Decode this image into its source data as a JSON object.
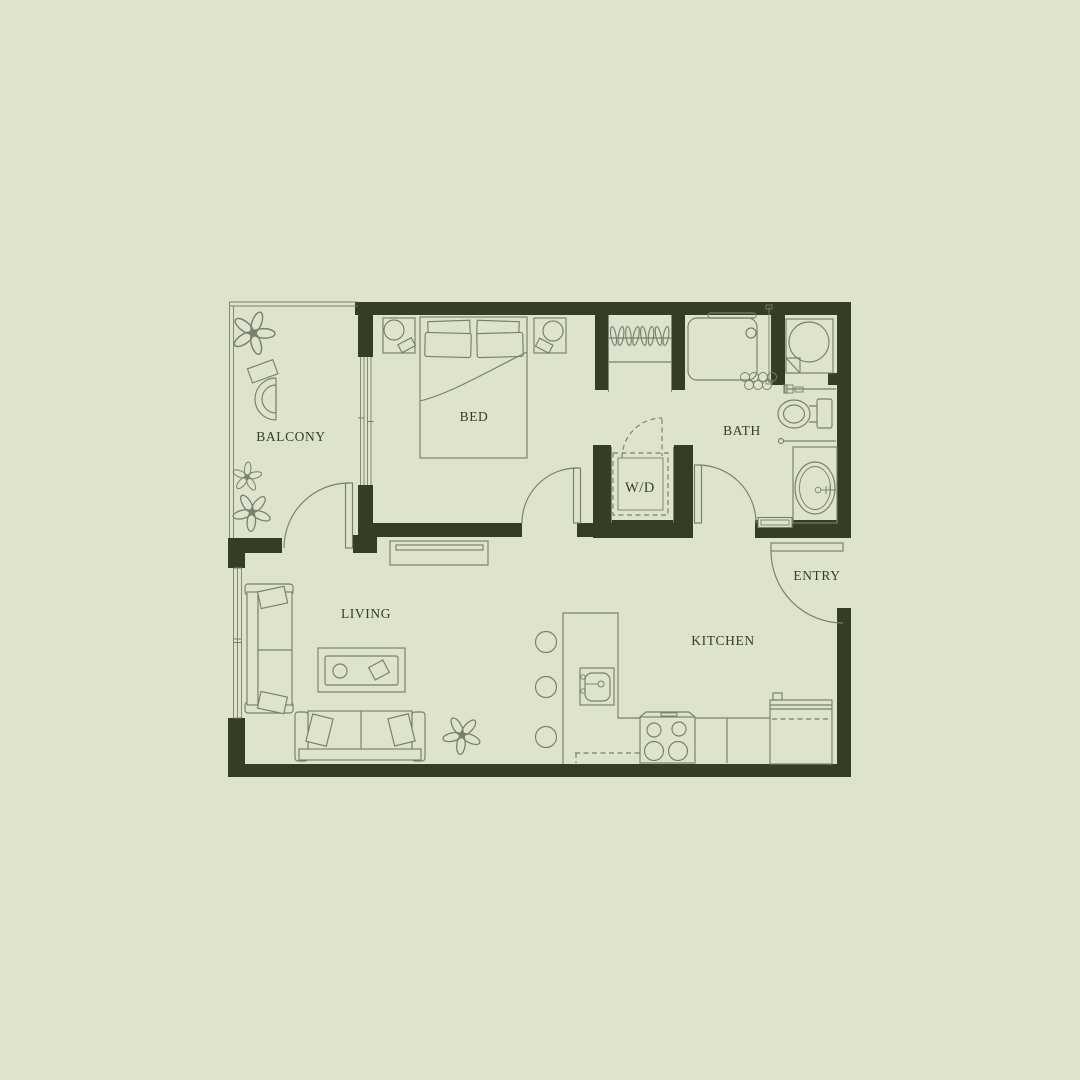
{
  "plan": {
    "rooms": {
      "balcony": {
        "label": "BALCONY"
      },
      "bedroom": {
        "label": "BED"
      },
      "laundry": {
        "label": "W/D"
      },
      "bath": {
        "label": "BATH"
      },
      "entry": {
        "label": "ENTRY"
      },
      "living": {
        "label": "LIVING"
      },
      "kitchen": {
        "label": "KITCHEN"
      }
    },
    "furniture": [
      "queen-bed",
      "nightstand",
      "table-lamp",
      "hanger-closet",
      "washer-dryer",
      "shower",
      "shower-curtain",
      "water-heater",
      "toilet",
      "towel-bar",
      "bathroom-vanity",
      "bath-mat",
      "loveseat",
      "sofa",
      "coffee-table",
      "tv-console",
      "potted-plant",
      "balcony-chair",
      "side-table",
      "bar-stool",
      "kitchen-sink",
      "range-stove",
      "refrigerator",
      "sliding-glass-door",
      "swing-door"
    ]
  },
  "colors": {
    "background": "#dde3cd",
    "wall": "#333e25",
    "line": "#76806a",
    "label": "#333e25"
  }
}
